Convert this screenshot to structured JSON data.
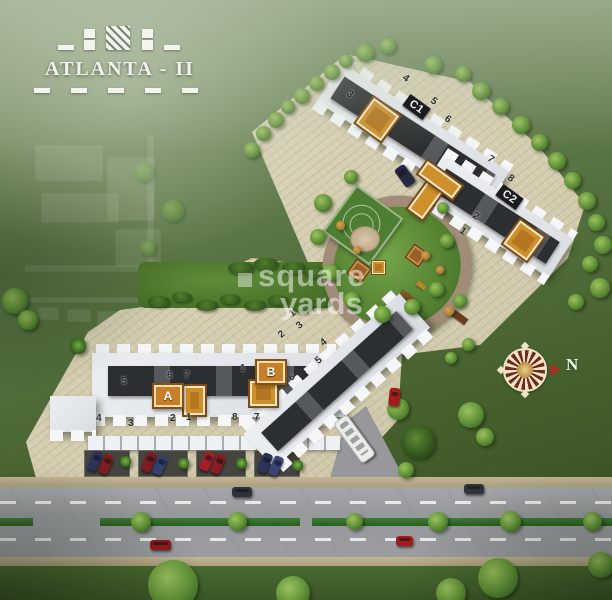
{
  "logo": {
    "title": "ATLANTA - II"
  },
  "watermark": {
    "line1": "square",
    "line2": "yards"
  },
  "compass": {
    "label": "N"
  },
  "colors": {
    "accent_orange": "#cf8f2b",
    "paving": "#d9d2b6",
    "road": "#9b9da0",
    "median_green": "#2f6d2b",
    "garden_green": "#5c8c39",
    "building_light": "#e4e7ea",
    "building_core": "#2c2f31"
  },
  "labels": [
    {
      "text": "C1",
      "x": 404,
      "y": 100,
      "rot": 36,
      "cls": "blabel"
    },
    {
      "text": "C2",
      "x": 497,
      "y": 190,
      "rot": 36,
      "cls": "blabel"
    },
    {
      "text": "A",
      "x": 152,
      "y": 383,
      "cls": "obox"
    },
    {
      "text": "B",
      "x": 255,
      "y": 359,
      "cls": "obox"
    }
  ],
  "unit_numbers": [
    {
      "text": "3",
      "x": 347,
      "y": 89,
      "rot": 36
    },
    {
      "text": "4",
      "x": 403,
      "y": 73,
      "rot": 36
    },
    {
      "text": "5",
      "x": 431,
      "y": 96,
      "rot": 36
    },
    {
      "text": "6",
      "x": 445,
      "y": 114,
      "rot": 36
    },
    {
      "text": "7",
      "x": 488,
      "y": 154,
      "rot": 36
    },
    {
      "text": "8",
      "x": 508,
      "y": 173,
      "rot": 36
    },
    {
      "text": "2",
      "x": 473,
      "y": 211,
      "rot": 36
    },
    {
      "text": "1",
      "x": 460,
      "y": 226,
      "rot": 36
    },
    {
      "text": "5",
      "x": 121,
      "y": 376
    },
    {
      "text": "6",
      "x": 167,
      "y": 370
    },
    {
      "text": "7",
      "x": 184,
      "y": 370
    },
    {
      "text": "1",
      "x": 240,
      "y": 363
    },
    {
      "text": "4",
      "x": 96,
      "y": 413
    },
    {
      "text": "3",
      "x": 128,
      "y": 418
    },
    {
      "text": "2",
      "x": 170,
      "y": 413
    },
    {
      "text": "1",
      "x": 186,
      "y": 412
    },
    {
      "text": "8",
      "x": 232,
      "y": 412
    },
    {
      "text": "7",
      "x": 254,
      "y": 412
    },
    {
      "text": "1",
      "x": 290,
      "y": 308,
      "rot": -40
    },
    {
      "text": "2",
      "x": 279,
      "y": 329,
      "rot": -40
    },
    {
      "text": "3",
      "x": 297,
      "y": 320,
      "rot": -40
    },
    {
      "text": "4",
      "x": 321,
      "y": 337,
      "rot": -40
    },
    {
      "text": "5",
      "x": 316,
      "y": 355,
      "rot": -40
    },
    {
      "text": "6",
      "x": 289,
      "y": 372,
      "rot": -40
    }
  ],
  "trees": [
    {
      "x": 244,
      "y": 142,
      "s": 16
    },
    {
      "x": 256,
      "y": 126,
      "s": 15
    },
    {
      "x": 268,
      "y": 112,
      "s": 16
    },
    {
      "x": 281,
      "y": 100,
      "s": 14
    },
    {
      "x": 294,
      "y": 88,
      "s": 16
    },
    {
      "x": 309,
      "y": 76,
      "s": 15
    },
    {
      "x": 324,
      "y": 64,
      "s": 16
    },
    {
      "x": 339,
      "y": 54,
      "s": 14
    },
    {
      "x": 356,
      "y": 44,
      "s": 18
    },
    {
      "x": 380,
      "y": 38,
      "s": 16
    },
    {
      "x": 424,
      "y": 56,
      "s": 18
    },
    {
      "x": 455,
      "y": 66,
      "s": 16
    },
    {
      "x": 472,
      "y": 82,
      "s": 18
    },
    {
      "x": 492,
      "y": 98,
      "s": 17
    },
    {
      "x": 512,
      "y": 116,
      "s": 18
    },
    {
      "x": 531,
      "y": 134,
      "s": 17
    },
    {
      "x": 548,
      "y": 152,
      "s": 18
    },
    {
      "x": 564,
      "y": 172,
      "s": 17
    },
    {
      "x": 578,
      "y": 192,
      "s": 18
    },
    {
      "x": 588,
      "y": 214,
      "s": 17
    },
    {
      "x": 594,
      "y": 236,
      "s": 18
    },
    {
      "x": 582,
      "y": 256,
      "s": 16
    },
    {
      "x": 590,
      "y": 278,
      "s": 20
    },
    {
      "x": 568,
      "y": 294,
      "s": 16
    },
    {
      "x": 314,
      "y": 194,
      "s": 18
    },
    {
      "x": 310,
      "y": 229,
      "s": 16
    },
    {
      "x": 322,
      "y": 264,
      "s": 17
    },
    {
      "x": 344,
      "y": 292,
      "s": 16
    },
    {
      "x": 374,
      "y": 306,
      "s": 17
    },
    {
      "x": 404,
      "y": 299,
      "s": 16
    },
    {
      "x": 429,
      "y": 282,
      "s": 15
    },
    {
      "x": 440,
      "y": 234,
      "s": 14
    },
    {
      "x": 437,
      "y": 202,
      "s": 12
    },
    {
      "x": 344,
      "y": 170,
      "s": 14
    },
    {
      "x": 336,
      "y": 221,
      "s": 9,
      "cls": "autumn"
    },
    {
      "x": 421,
      "y": 251,
      "s": 9,
      "cls": "autumn"
    },
    {
      "x": 436,
      "y": 266,
      "s": 8,
      "cls": "autumn"
    },
    {
      "x": 353,
      "y": 246,
      "s": 8,
      "cls": "autumn"
    },
    {
      "x": 444,
      "y": 306,
      "s": 10,
      "cls": "autumn"
    },
    {
      "x": 453,
      "y": 294,
      "s": 14
    },
    {
      "x": 462,
      "y": 338,
      "s": 13
    },
    {
      "x": 445,
      "y": 352,
      "s": 12
    },
    {
      "x": 387,
      "y": 398,
      "s": 22
    },
    {
      "x": 458,
      "y": 402,
      "s": 26
    },
    {
      "x": 401,
      "y": 425,
      "s": 34,
      "cls": "bushdk"
    },
    {
      "x": 476,
      "y": 428,
      "s": 18
    },
    {
      "x": 2,
      "y": 288,
      "s": 26
    },
    {
      "x": 18,
      "y": 310,
      "s": 20
    },
    {
      "x": 70,
      "y": 338,
      "s": 16,
      "cls": "palm"
    },
    {
      "x": 398,
      "y": 462,
      "s": 16
    },
    {
      "x": 148,
      "y": 560,
      "s": 50
    },
    {
      "x": 276,
      "y": 576,
      "s": 34
    },
    {
      "x": 436,
      "y": 578,
      "s": 30
    },
    {
      "x": 478,
      "y": 558,
      "s": 40
    },
    {
      "x": 588,
      "y": 552,
      "s": 26
    },
    {
      "x": 131,
      "y": 512,
      "s": 20
    },
    {
      "x": 228,
      "y": 512,
      "s": 19
    },
    {
      "x": 346,
      "y": 513,
      "s": 17
    },
    {
      "x": 428,
      "y": 512,
      "s": 20
    },
    {
      "x": 500,
      "y": 511,
      "s": 21
    },
    {
      "x": 583,
      "y": 512,
      "s": 19
    },
    {
      "x": 120,
      "y": 456,
      "s": 11,
      "cls": "palm"
    },
    {
      "x": 178,
      "y": 458,
      "s": 11,
      "cls": "palm"
    },
    {
      "x": 236,
      "y": 458,
      "s": 11,
      "cls": "palm"
    },
    {
      "x": 292,
      "y": 460,
      "s": 11,
      "cls": "palm"
    },
    {
      "x": 134,
      "y": 162,
      "s": 20,
      "cls": "dim"
    },
    {
      "x": 140,
      "y": 240,
      "s": 16,
      "cls": "dim"
    },
    {
      "x": 162,
      "y": 200,
      "s": 22,
      "cls": "dim"
    }
  ],
  "hedges": [
    {
      "x": 148,
      "y": 296,
      "w": 22,
      "h": 11
    },
    {
      "x": 172,
      "y": 292,
      "w": 20,
      "h": 10
    },
    {
      "x": 196,
      "y": 300,
      "w": 22,
      "h": 11
    },
    {
      "x": 220,
      "y": 294,
      "w": 20,
      "h": 10
    },
    {
      "x": 244,
      "y": 300,
      "w": 22,
      "h": 11
    },
    {
      "x": 268,
      "y": 295,
      "w": 20,
      "h": 10
    },
    {
      "x": 292,
      "y": 302,
      "w": 22,
      "h": 11
    },
    {
      "x": 312,
      "y": 298,
      "w": 18,
      "h": 10
    },
    {
      "x": 228,
      "y": 262,
      "w": 26,
      "h": 12
    },
    {
      "x": 254,
      "y": 258,
      "w": 24,
      "h": 12
    },
    {
      "x": 282,
      "y": 262,
      "w": 24,
      "h": 12
    },
    {
      "x": 304,
      "y": 266,
      "w": 22,
      "h": 12
    }
  ],
  "cars": [
    {
      "x": 90,
      "y": 451,
      "w": 10,
      "h": 20,
      "rot": 24,
      "c": "#2c3258"
    },
    {
      "x": 101,
      "y": 454,
      "w": 10,
      "h": 20,
      "rot": 24,
      "c": "#7c1d22"
    },
    {
      "x": 144,
      "y": 452,
      "w": 10,
      "h": 20,
      "rot": 24,
      "c": "#7c1d22"
    },
    {
      "x": 155,
      "y": 455,
      "w": 10,
      "h": 20,
      "rot": 24,
      "c": "#333f6e"
    },
    {
      "x": 202,
      "y": 451,
      "w": 10,
      "h": 20,
      "rot": 24,
      "c": "#a02026"
    },
    {
      "x": 213,
      "y": 454,
      "w": 10,
      "h": 20,
      "rot": 24,
      "c": "#8a1b20"
    },
    {
      "x": 260,
      "y": 453,
      "w": 10,
      "h": 20,
      "rot": 24,
      "c": "#2c3258"
    },
    {
      "x": 271,
      "y": 456,
      "w": 10,
      "h": 20,
      "rot": 24,
      "c": "#3a4474"
    },
    {
      "x": 232,
      "y": 487,
      "w": 20,
      "h": 10,
      "c": "#2e3136"
    },
    {
      "x": 464,
      "y": 484,
      "w": 20,
      "h": 10,
      "c": "#30333a"
    },
    {
      "x": 150,
      "y": 540,
      "w": 21,
      "h": 10,
      "c": "#8e1a1a"
    },
    {
      "x": 396,
      "y": 536,
      "w": 17,
      "h": 10,
      "c": "#a31d1d"
    },
    {
      "x": 399,
      "y": 165,
      "w": 12,
      "h": 22,
      "rot": -36,
      "c": "#262a40"
    },
    {
      "x": 389,
      "y": 388,
      "w": 11,
      "h": 18,
      "rot": 6,
      "c": "#a51c1c"
    },
    {
      "x": 346,
      "y": 414,
      "w": 15,
      "h": 48,
      "rot": -36,
      "c": "#e9ece9",
      "cls": "bus"
    }
  ],
  "orange_marks": [
    {
      "x": 362,
      "y": 104,
      "w": 27,
      "h": 27,
      "rot": 36
    },
    {
      "x": 509,
      "y": 226,
      "w": 25,
      "h": 25,
      "rot": 36
    },
    {
      "x": 184,
      "y": 386,
      "w": 17,
      "h": 25
    },
    {
      "x": 250,
      "y": 381,
      "w": 23,
      "h": 21
    },
    {
      "x": 372,
      "y": 261,
      "w": 11,
      "h": 11,
      "cls": "sm"
    }
  ],
  "parking_bays": [
    {
      "x": 84,
      "y": 450,
      "w": 46,
      "h": 27
    },
    {
      "x": 138,
      "y": 450,
      "w": 50,
      "h": 27
    },
    {
      "x": 196,
      "y": 450,
      "w": 50,
      "h": 27
    },
    {
      "x": 254,
      "y": 450,
      "w": 46,
      "h": 27
    }
  ],
  "median_segments": [
    {
      "x": 0,
      "w": 33
    },
    {
      "x": 100,
      "w": 200
    },
    {
      "x": 312,
      "w": 300
    }
  ],
  "ghost_plan": [
    {
      "x": 36,
      "y": 146,
      "w": 66,
      "h": 34
    },
    {
      "x": 108,
      "y": 158,
      "w": 46,
      "h": 62
    },
    {
      "x": 42,
      "y": 194,
      "w": 76,
      "h": 28
    },
    {
      "x": 116,
      "y": 230,
      "w": 44,
      "h": 36
    },
    {
      "x": 148,
      "y": 136,
      "w": 5,
      "h": 154
    },
    {
      "x": 26,
      "y": 266,
      "w": 142,
      "h": 5
    },
    {
      "x": 26,
      "y": 298,
      "w": 152,
      "h": 4
    },
    {
      "x": 38,
      "y": 308,
      "w": 20,
      "h": 11
    },
    {
      "x": 68,
      "y": 310,
      "w": 22,
      "h": 11
    },
    {
      "x": 98,
      "y": 312,
      "w": 22,
      "h": 11
    }
  ]
}
